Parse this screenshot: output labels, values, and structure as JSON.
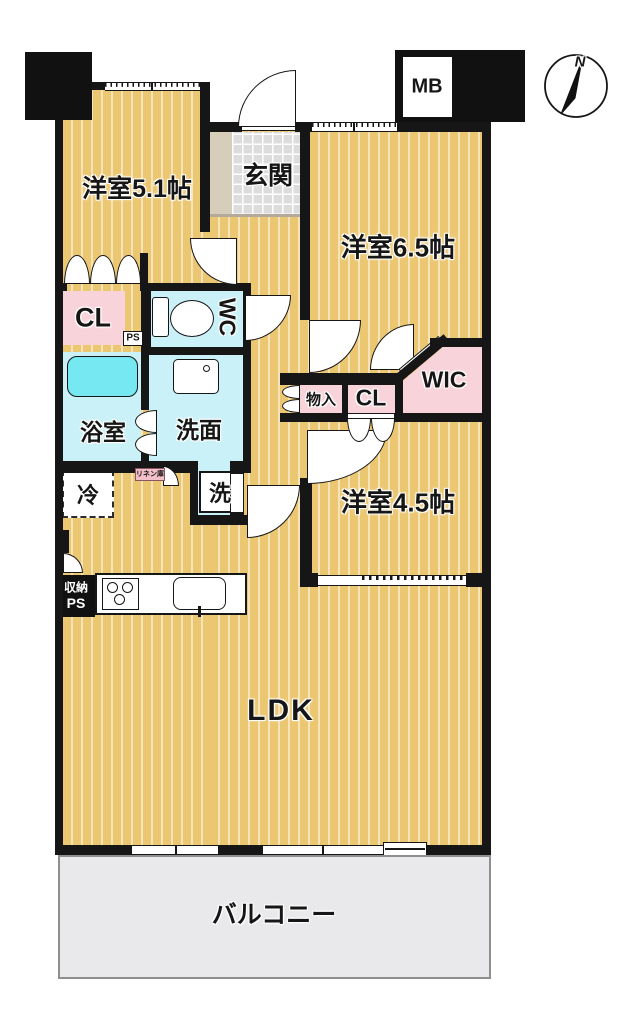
{
  "title": "apartment-floor-plan",
  "compass": {
    "north_label": "N"
  },
  "meter_box": {
    "label": "MB"
  },
  "rooms": {
    "bedroom_5_1": "洋室5.1帖",
    "entrance": "玄関",
    "bedroom_6_5": "洋室6.5帖",
    "closet_1": "CL",
    "pipe_space_1": "PS",
    "toilet": "WC",
    "bathroom": "浴室",
    "washroom": "洗面",
    "washer": "洗",
    "fridge": "冷",
    "linen_closet": "リネン庫",
    "storage_small": "物入",
    "closet_2": "CL",
    "walk_in_closet": "WIC",
    "bedroom_4_5": "洋室4.5帖",
    "living_dining_kitchen": "LDK",
    "balcony": "バルコニー",
    "storage_hall": "収納",
    "pipe_space_2": "PS"
  },
  "colors": {
    "floor_tan": "#ecc772",
    "closet_pink": "#f8d3da",
    "wet_area_cyan": "#c9f1f7",
    "bathtub_cyan": "#76e8f2",
    "entrance_tile_gray": "#dcdcdc",
    "balcony_gray": "#e9e9eb",
    "wall_black": "#161616"
  }
}
